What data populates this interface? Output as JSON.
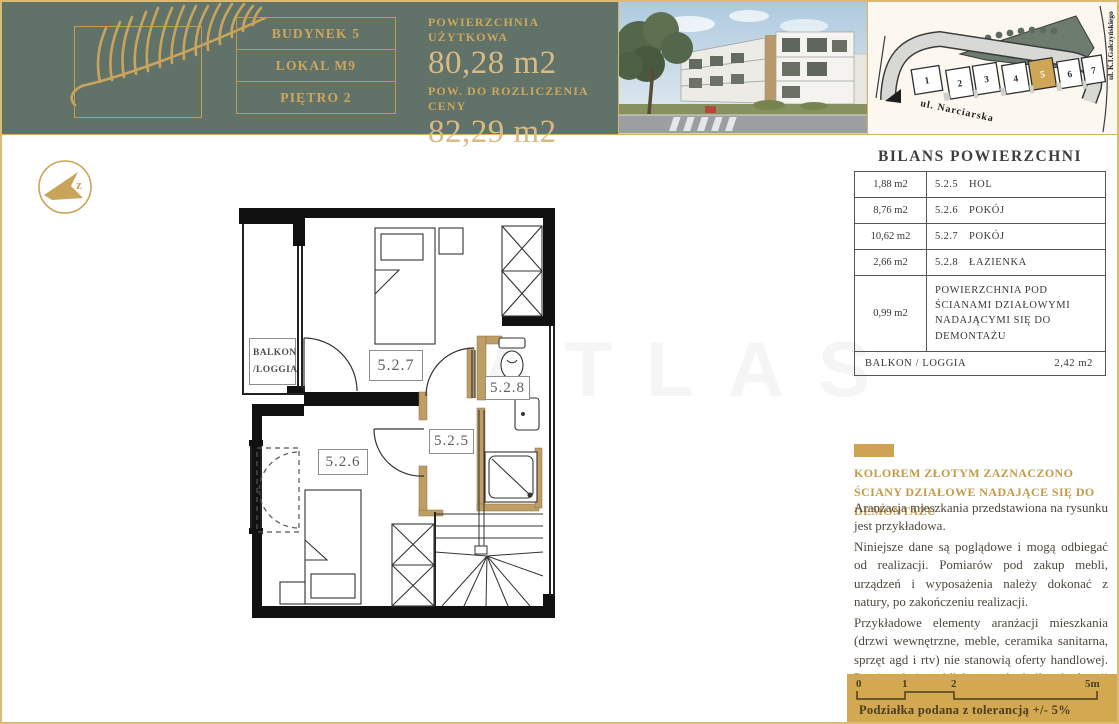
{
  "header": {
    "building_label": "BUDYNEK 5",
    "unit_label": "LOKAL M9",
    "floor_label": "PIĘTRO 2",
    "usable_area_label": "POWIERZCHNIA UŻYTKOWA",
    "usable_area_value": "80,28 m2",
    "billing_area_label": "POW. DO ROZLICZENIA CENY",
    "billing_area_value": "82,29 m2"
  },
  "site_map": {
    "street_bottom": "ul. Narciarska",
    "street_right": "ul. K.I.Gałczyńskiego",
    "buildings": [
      "1",
      "2",
      "3",
      "4",
      "5",
      "6",
      "7"
    ],
    "highlighted_building": "5",
    "highlight_color": "#cfa556"
  },
  "balance_table": {
    "title": "BILANS POWIERZCHNI",
    "rows": [
      {
        "area": "1,88 m2",
        "code": "5.2.5",
        "name": "HOL"
      },
      {
        "area": "8,76 m2",
        "code": "5.2.6",
        "name": "POKÓJ"
      },
      {
        "area": "10,62 m2",
        "code": "5.2.7",
        "name": "POKÓJ"
      },
      {
        "area": "2,66 m2",
        "code": "5.2.8",
        "name": "ŁAZIENKA"
      },
      {
        "area": "0,99 m2",
        "code": "",
        "name": "POWIERZCHNIA POD ŚCIANAMI DZIAŁOWYMI NADAJĄCYMI SIĘ DO DEMONTAŻU"
      }
    ],
    "footer_label": "BALKON / LOGGIA",
    "footer_value": "2,42 m2"
  },
  "notes": {
    "gold_note": "KOLOREM ZŁOTYM ZAZNACZONO ŚCIANY DZIAŁOWE NADAJĄCE SIĘ DO DEMONTAŻU",
    "paragraph1": "Aranżacja mieszkania przedstawiona na rysunku jest przykładowa.",
    "paragraph2": "Niniejsze dane są poglądowe i mogą odbiegać od realizacji. Pomiarów pod zakup mebli, urządzeń i wyposażenia należy dokonać z natury, po zakończeniu realizacji.",
    "paragraph3": "Przykładowe elementy aranżacji mieszkania (drzwi wewnętrzne, meble, ceramika sanitarna, sprzęt agd i rtv) nie stanowią oferty handlowej. Powierzchni ogródków tarasów balkonów loggii nie podlegają obmiarowi."
  },
  "floor_plan": {
    "room_codes": [
      "5.2.5",
      "5.2.6",
      "5.2.7",
      "5.2.8"
    ],
    "balcony_label_line1": "BALKON",
    "balcony_label_line2": "/LOGGIA",
    "gold_wall_color": "#bf9e66"
  },
  "compass": {
    "letter": "z"
  },
  "watermark": {
    "text": "ATLAS"
  },
  "scale_bar": {
    "tick0": "0",
    "tick1": "1",
    "tick2": "2",
    "tick3": "5m",
    "caption": "Podziałka podana z tolerancją +/- 5%"
  },
  "colors": {
    "header_green": "#617268",
    "gold_accent": "#cda75d",
    "scale_panel_gold": "#d2a850",
    "map_green": "#6d7c6e"
  }
}
